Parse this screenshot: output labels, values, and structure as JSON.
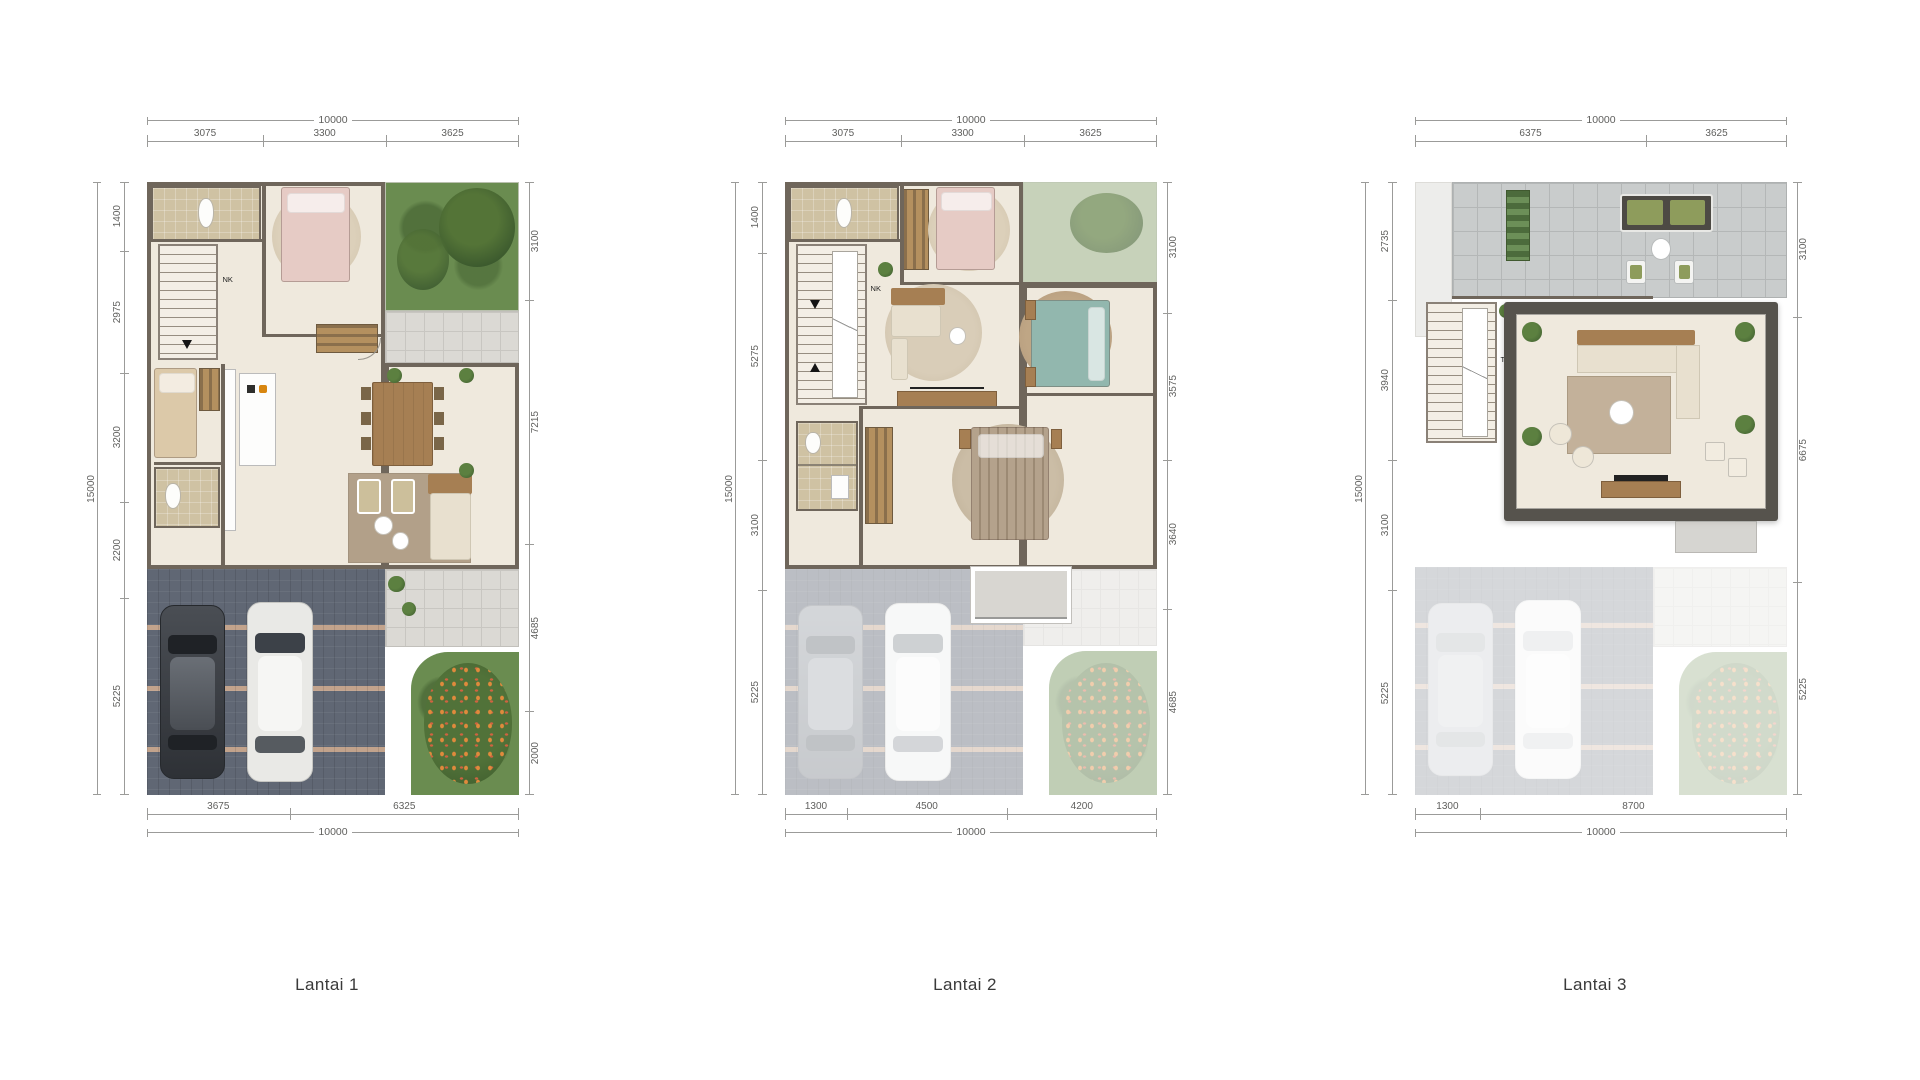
{
  "plans": [
    {
      "label": "Lantai 1",
      "note": "NK",
      "dims": {
        "top_total": "10000",
        "top_segments": [
          "3075",
          "3300",
          "3625"
        ],
        "left_total": "15000",
        "left_segments": [
          "1400",
          "2975",
          "3200",
          "2200",
          "5225"
        ],
        "right_segments": [
          "3100",
          "7215",
          "4685",
          "2000"
        ],
        "bottom_segments": [
          "3675",
          "6325"
        ],
        "bottom_total": "10000"
      }
    },
    {
      "label": "Lantai 2",
      "note": "NK",
      "dims": {
        "top_total": "10000",
        "top_segments": [
          "3075",
          "3300",
          "3625"
        ],
        "left_total": "15000",
        "left_segments": [
          "1400",
          "5275",
          "3100",
          "5225"
        ],
        "right_segments": [
          "3100",
          "3575",
          "3640",
          "4685"
        ],
        "bottom_segments": [
          "1300",
          "4500",
          "4200"
        ],
        "bottom_total": "10000"
      }
    },
    {
      "label": "Lantai 3",
      "note": "TR",
      "dims": {
        "top_total": "10000",
        "top_segments": [
          "6375",
          "3625"
        ],
        "left_total": "15000",
        "left_segments": [
          "2735",
          "3940",
          "3100",
          "5225"
        ],
        "right_segments": [
          "3100",
          "6675",
          "5225"
        ],
        "bottom_segments": [
          "1300",
          "8700"
        ],
        "bottom_total": "10000"
      }
    }
  ],
  "colors": {
    "wall": "#6f665b",
    "floor": "#efe9dd",
    "tile": "#dbd9d4",
    "bath": "#cfc2a3",
    "grass": "#6a8c50",
    "paving": "#606774",
    "pavingStripe": "#c2a38c",
    "wood": "#a67f53",
    "pinkBed": "#e6cbc5",
    "tealBed": "#92b7ae",
    "carDark": "#3a3e44",
    "carWhite": "#e9e9e6",
    "dimLine": "#9b9b99",
    "dimText": "#5f5f5d",
    "labelText": "#3a3a3a",
    "terrace": "#c9cccc",
    "roof": "#56534d"
  }
}
